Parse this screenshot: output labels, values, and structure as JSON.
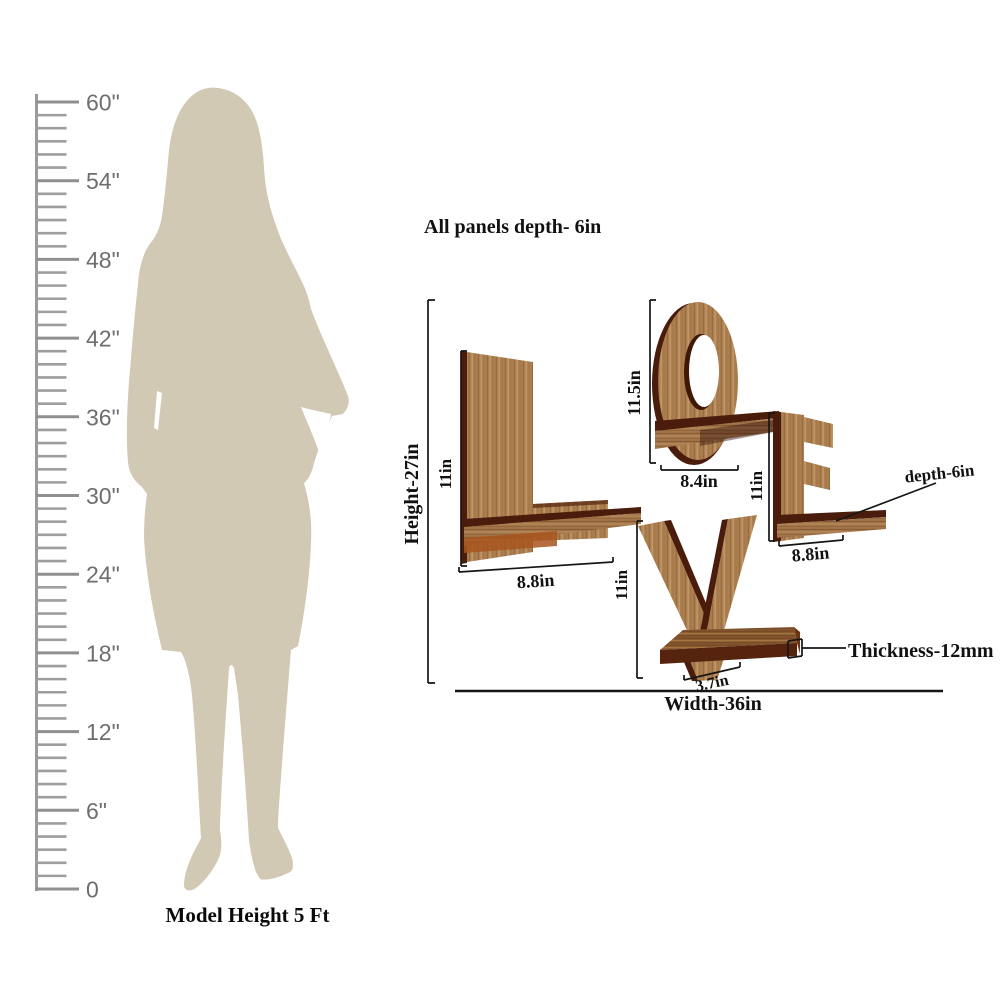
{
  "word": "LOVE",
  "ruler": {
    "unit_labels": [
      "60\"",
      "54\"",
      "48\"",
      "42\"",
      "36\"",
      "30\"",
      "24\"",
      "18\"",
      "12\"",
      "6\"",
      "0"
    ],
    "caption": "Model Height 5 Ft"
  },
  "dimensions": {
    "panel_depth_note": "All panels depth- 6in",
    "overall_height": "Height-27in",
    "overall_width": "Width-36in",
    "shelf_depth": "depth-6in",
    "thickness": "Thickness-12mm",
    "letters": [
      {
        "letter": "L",
        "height": "11in",
        "width": "8.8in"
      },
      {
        "letter": "O",
        "height": "11.5in",
        "width": "8.4in"
      },
      {
        "letter": "V",
        "height": "11in",
        "width": "3.7in"
      },
      {
        "letter": "E",
        "height": "11in",
        "width": "8.8in"
      }
    ]
  },
  "colors": {
    "silhouette": "#d2c9b4",
    "wood_base": "#ad8051",
    "wood_edge": "#4a1c0c",
    "dim_line": "#161616",
    "ruler_gray": "#9e9e9e"
  }
}
